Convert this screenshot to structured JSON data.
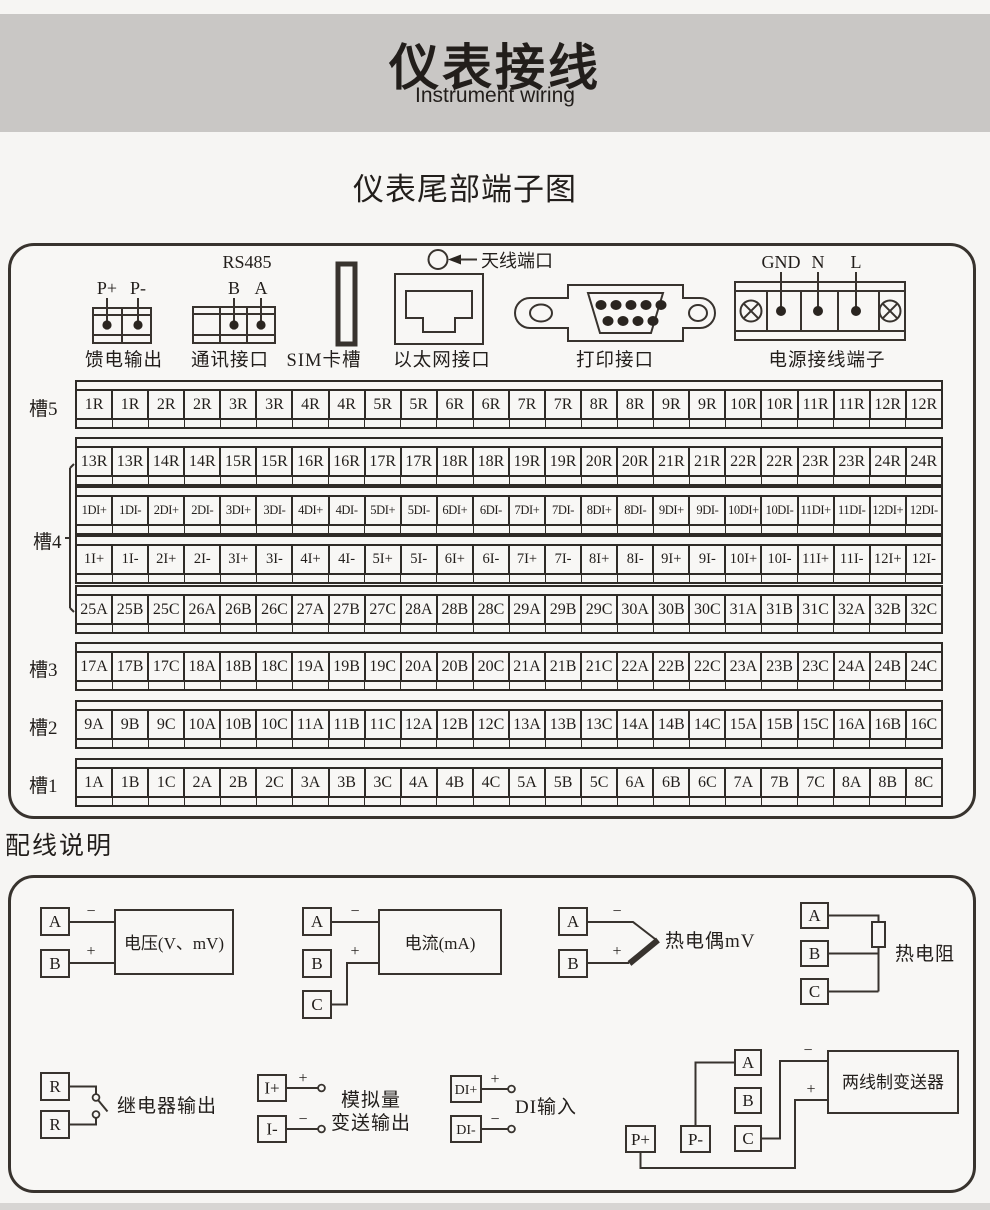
{
  "page": {
    "title": "仪表接线",
    "subtitle": "Instrument wiring",
    "section_title": "仪表尾部端子图",
    "wiring_heading": "配线说明"
  },
  "terminal_panel": {
    "connectors": {
      "feed": {
        "caption": "馈电输出",
        "pins": [
          "P+",
          "P-"
        ]
      },
      "comm": {
        "caption": "通讯接口",
        "bus": "RS485",
        "pins": [
          "B",
          "A"
        ]
      },
      "sim": {
        "caption": "SIM卡槽"
      },
      "ethernet": {
        "caption": "以太网接口"
      },
      "antenna": {
        "label": "天线端口"
      },
      "printer": {
        "caption": "打印接口"
      },
      "power": {
        "caption": "电源接线端子",
        "pins": [
          "GND",
          "N",
          "L"
        ]
      }
    },
    "slot4_label": "槽4",
    "strips": [
      {
        "slot": "槽5",
        "cells": [
          "1R",
          "1R",
          "2R",
          "2R",
          "3R",
          "3R",
          "4R",
          "4R",
          "5R",
          "5R",
          "6R",
          "6R",
          "7R",
          "7R",
          "8R",
          "8R",
          "9R",
          "9R",
          "10R",
          "10R",
          "11R",
          "11R",
          "12R",
          "12R"
        ]
      },
      {
        "slot": "",
        "cells": [
          "13R",
          "13R",
          "14R",
          "14R",
          "15R",
          "15R",
          "16R",
          "16R",
          "17R",
          "17R",
          "18R",
          "18R",
          "19R",
          "19R",
          "20R",
          "20R",
          "21R",
          "21R",
          "22R",
          "22R",
          "23R",
          "23R",
          "24R",
          "24R"
        ]
      },
      {
        "slot": "",
        "cells": [
          "1DI+",
          "1DI-",
          "2DI+",
          "2DI-",
          "3DI+",
          "3DI-",
          "4DI+",
          "4DI-",
          "5DI+",
          "5DI-",
          "6DI+",
          "6DI-",
          "7DI+",
          "7DI-",
          "8DI+",
          "8DI-",
          "9DI+",
          "9DI-",
          "10DI+",
          "10DI-",
          "11DI+",
          "11DI-",
          "12DI+",
          "12DI-"
        ]
      },
      {
        "slot": "",
        "cells": [
          "1I+",
          "1I-",
          "2I+",
          "2I-",
          "3I+",
          "3I-",
          "4I+",
          "4I-",
          "5I+",
          "5I-",
          "6I+",
          "6I-",
          "7I+",
          "7I-",
          "8I+",
          "8I-",
          "9I+",
          "9I-",
          "10I+",
          "10I-",
          "11I+",
          "11I-",
          "12I+",
          "12I-"
        ]
      },
      {
        "slot": "",
        "cells": [
          "25A",
          "25B",
          "25C",
          "26A",
          "26B",
          "26C",
          "27A",
          "27B",
          "27C",
          "28A",
          "28B",
          "28C",
          "29A",
          "29B",
          "29C",
          "30A",
          "30B",
          "30C",
          "31A",
          "31B",
          "31C",
          "32A",
          "32B",
          "32C"
        ]
      },
      {
        "slot": "槽3",
        "cells": [
          "17A",
          "17B",
          "17C",
          "18A",
          "18B",
          "18C",
          "19A",
          "19B",
          "19C",
          "20A",
          "20B",
          "20C",
          "21A",
          "21B",
          "21C",
          "22A",
          "22B",
          "22C",
          "23A",
          "23B",
          "23C",
          "24A",
          "24B",
          "24C"
        ]
      },
      {
        "slot": "槽2",
        "cells": [
          "9A",
          "9B",
          "9C",
          "10A",
          "10B",
          "10C",
          "11A",
          "11B",
          "11C",
          "12A",
          "12B",
          "12C",
          "13A",
          "13B",
          "13C",
          "14A",
          "14B",
          "14C",
          "15A",
          "15B",
          "15C",
          "16A",
          "16B",
          "16C"
        ]
      },
      {
        "slot": "槽1",
        "cells": [
          "1A",
          "1B",
          "1C",
          "2A",
          "2B",
          "2C",
          "3A",
          "3B",
          "3C",
          "4A",
          "4B",
          "4C",
          "5A",
          "5B",
          "5C",
          "6A",
          "6B",
          "6C",
          "7A",
          "7B",
          "7C",
          "8A",
          "8B",
          "8C"
        ]
      }
    ]
  },
  "wiring": {
    "voltage": {
      "t1": "A",
      "t2": "B",
      "minus": "−",
      "plus": "+",
      "label": "电压(V、mV)"
    },
    "current": {
      "t1": "A",
      "t2": "B",
      "t3": "C",
      "minus": "−",
      "plus": "+",
      "label": "电流(mA)"
    },
    "thermocouple": {
      "t1": "A",
      "t2": "B",
      "minus": "−",
      "plus": "+",
      "label": "热电偶mV"
    },
    "rtd": {
      "t1": "A",
      "t2": "B",
      "t3": "C",
      "label": "热电阻"
    },
    "relay": {
      "t1": "R",
      "t2": "R",
      "label": "继电器输出"
    },
    "analog_out": {
      "t1": "I+",
      "t2": "I-",
      "plus": "+",
      "minus": "−",
      "label_line1": "模拟量",
      "label_line2": "变送输出"
    },
    "di": {
      "t1": "DI+",
      "t2": "DI-",
      "plus": "+",
      "minus": "−",
      "label": "DI输入"
    },
    "transmitter": {
      "t1": "A",
      "t2": "B",
      "t3": "C",
      "p_plus": "P+",
      "p_minus": "P-",
      "plus": "+",
      "minus": "−",
      "label": "两线制变送器"
    }
  },
  "colors": {
    "line": "#38332e",
    "band": "#c9c7c5",
    "page_bg": "#f6f5f3"
  }
}
